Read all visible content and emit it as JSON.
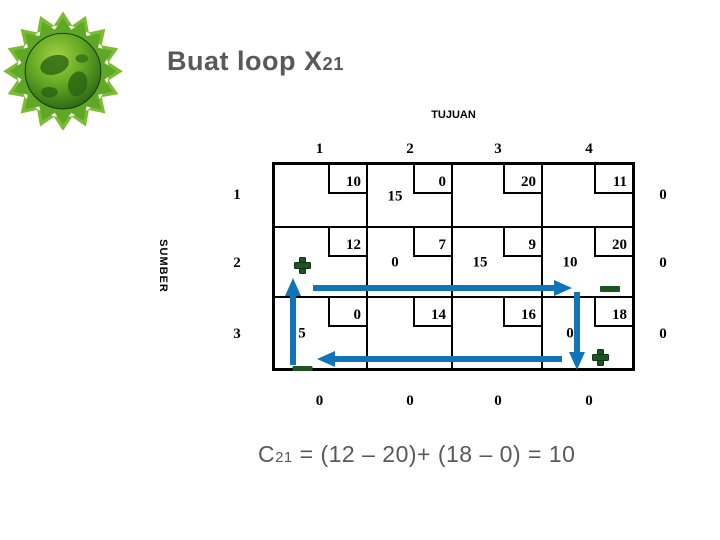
{
  "slide": {
    "title": {
      "text": "Buat loop X",
      "subscript": "21"
    },
    "formula": {
      "lhs": "C",
      "lhs_sub": "21",
      "expression": " = (12 – 20)+ (18 – 0) = 10"
    }
  },
  "colors": {
    "arrow_blue": "#1173B8",
    "sign_green": "#1C5523",
    "sign_green_edge": "#0E3313",
    "heading_gray": "#595959",
    "logo_green": "#63A824"
  },
  "table": {
    "top_axis_label": "TUJUAN",
    "left_axis_label": "SUMBER",
    "col_headers": [
      "1",
      "2",
      "3",
      "4"
    ],
    "row_headers": [
      "1",
      "2",
      "3"
    ],
    "supply": [
      "0",
      "0",
      "0"
    ],
    "demand": [
      "0",
      "0",
      "0",
      "0"
    ],
    "rows": [
      {
        "cells": [
          {
            "cost": "10"
          },
          {
            "cost": "0",
            "alloc": "15"
          },
          {
            "cost": "20"
          },
          {
            "cost": "11"
          }
        ]
      },
      {
        "cells": [
          {
            "cost": "12",
            "sign": "plus"
          },
          {
            "cost": "7",
            "alloc": "0"
          },
          {
            "cost": "9",
            "alloc": "15"
          },
          {
            "cost": "20",
            "alloc": "10",
            "sign": "minus"
          }
        ]
      },
      {
        "cells": [
          {
            "cost": "0",
            "alloc": "5",
            "sign": "minus"
          },
          {
            "cost": "14"
          },
          {
            "cost": "16"
          },
          {
            "cost": "18",
            "alloc": "0",
            "sign": "plus"
          }
        ]
      }
    ]
  },
  "loop": {
    "variable": "X21",
    "arrows": [
      {
        "direction": "up",
        "from_cell": "3,1",
        "to_cell": "2,1"
      },
      {
        "direction": "right",
        "from_cell": "2,1",
        "to_cell": "2,4"
      },
      {
        "direction": "down",
        "from_cell": "2,4",
        "to_cell": "3,4"
      },
      {
        "direction": "left",
        "from_cell": "3,4",
        "to_cell": "3,1"
      }
    ],
    "signs": [
      {
        "cell": "2,1",
        "type": "plus"
      },
      {
        "cell": "2,4",
        "type": "minus"
      },
      {
        "cell": "3,1",
        "type": "minus"
      },
      {
        "cell": "3,4",
        "type": "plus"
      }
    ]
  }
}
